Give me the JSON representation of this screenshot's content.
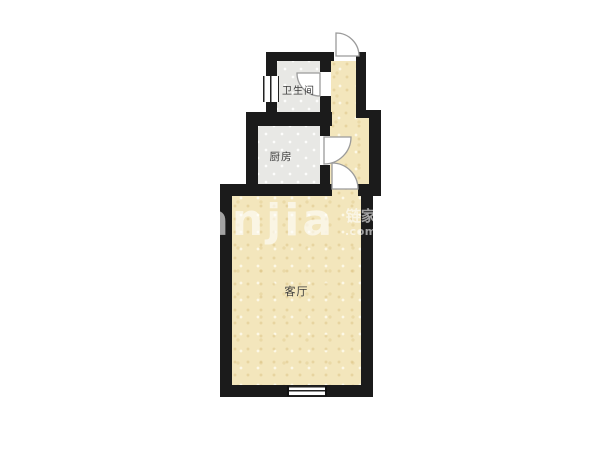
{
  "floorplan": {
    "rooms": [
      {
        "id": "bathroom",
        "label": "卫生间"
      },
      {
        "id": "kitchen",
        "label": "厨房"
      },
      {
        "id": "living-room",
        "label": "客厅"
      }
    ],
    "watermark": {
      "brand": "Lianjia",
      "brand_cn": "链家",
      "suffix": ".com"
    },
    "colors": {
      "wall": "#1b1b1b",
      "floor_warm": "#f3e6bc",
      "floor_tile": "#e8e8e5",
      "door_stroke": "#9b9b9b",
      "room_label": "#3c3c3c",
      "watermark_white": "rgba(255,255,255,0.6)"
    }
  }
}
